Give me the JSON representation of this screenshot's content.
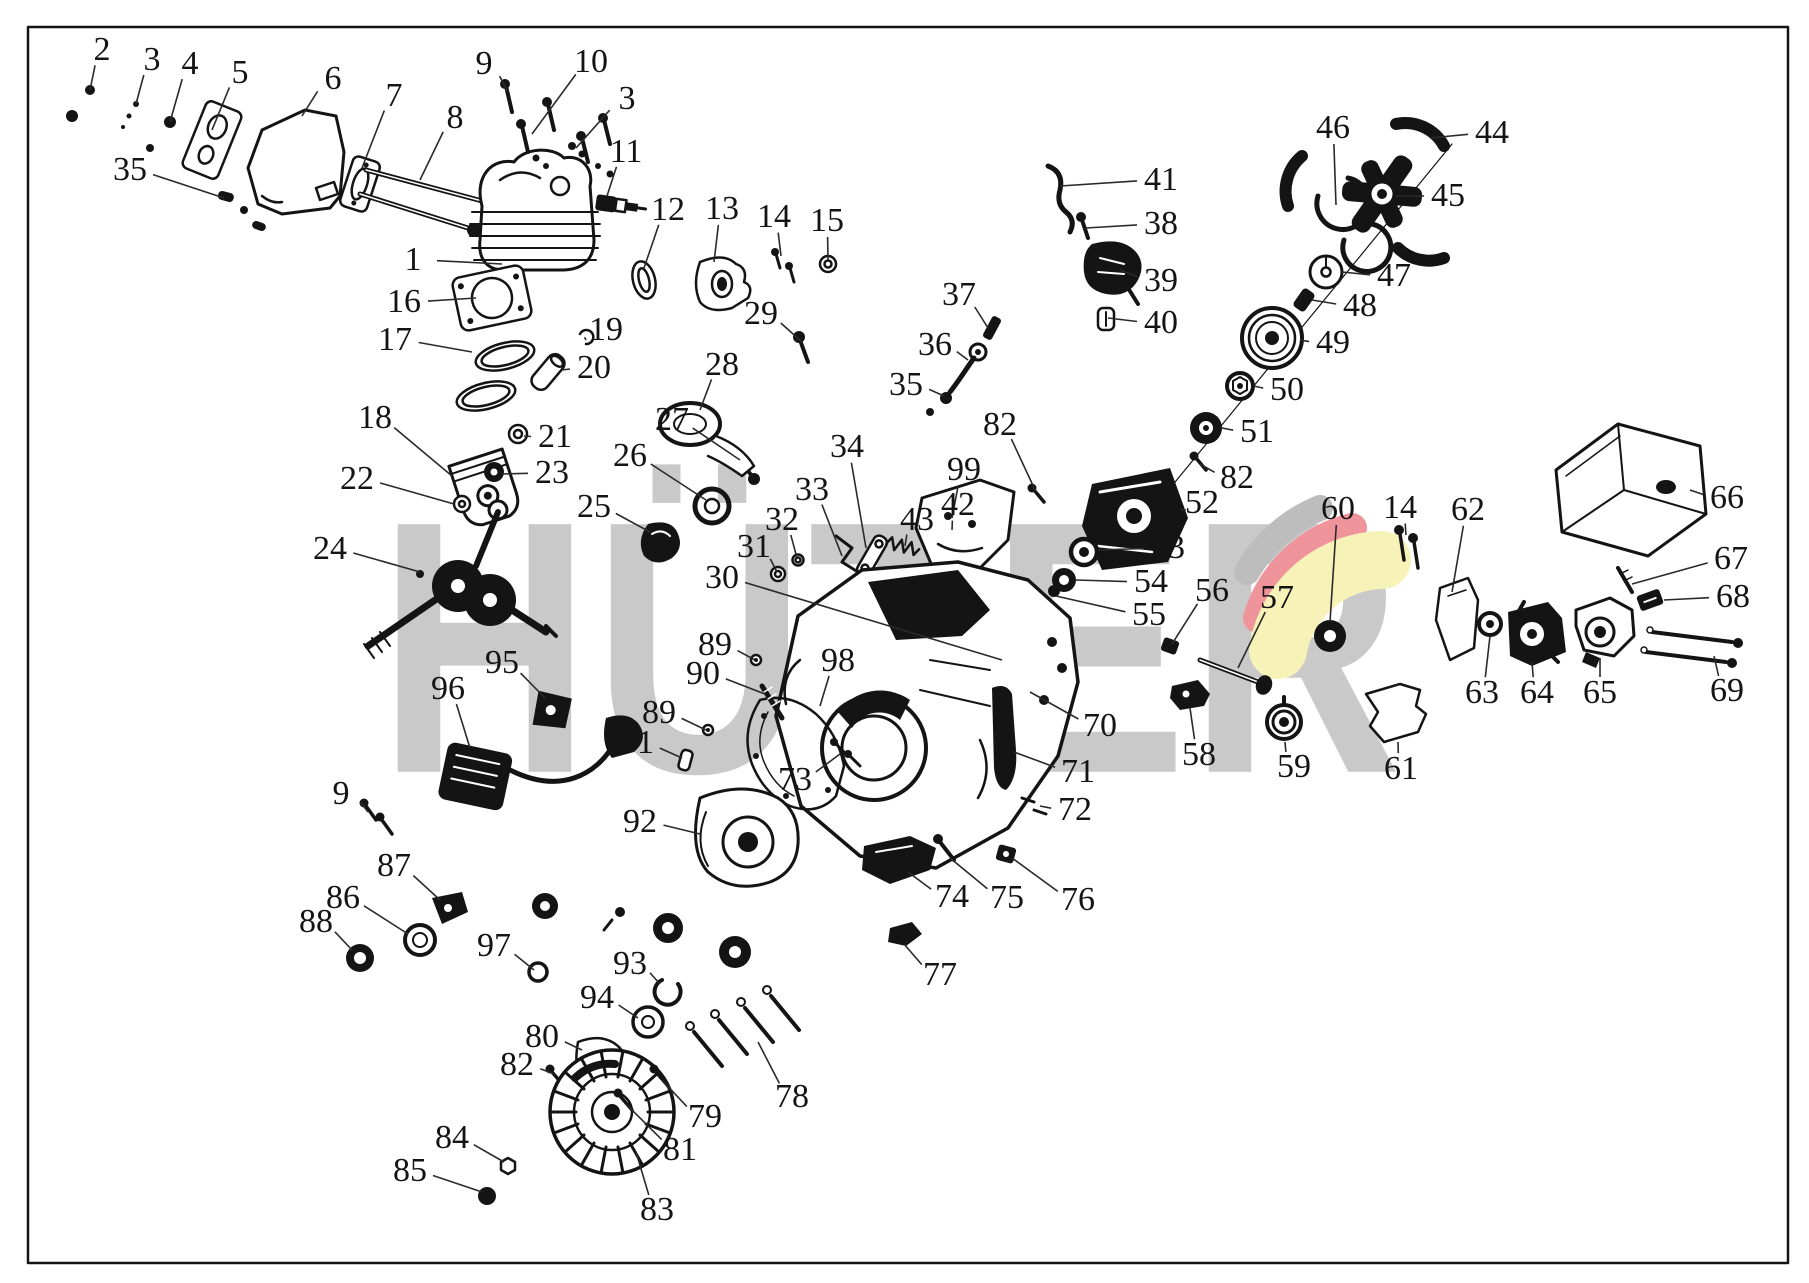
{
  "watermark": {
    "text": "HÜTER",
    "color": "#c9c9c9"
  },
  "logo": {
    "gray": "#bdbdbd",
    "red": "#f0949c",
    "yellow": "#f7f2b8"
  },
  "frame": {
    "border_color": "#141414"
  },
  "diagram": {
    "type": "exploded-parts-diagram",
    "callouts": [
      {
        "label": "2",
        "x": 102,
        "y": 50,
        "tx": 90,
        "ty": 90
      },
      {
        "label": "3",
        "x": 152,
        "y": 60,
        "tx": 136,
        "ty": 104
      },
      {
        "label": "4",
        "x": 190,
        "y": 64,
        "tx": 170,
        "ty": 122
      },
      {
        "label": "5",
        "x": 240,
        "y": 73,
        "tx": 212,
        "ty": 130
      },
      {
        "label": "6",
        "x": 333,
        "y": 79,
        "tx": 302,
        "ty": 116
      },
      {
        "label": "7",
        "x": 394,
        "y": 96,
        "tx": 362,
        "ty": 168
      },
      {
        "label": "8",
        "x": 455,
        "y": 118,
        "tx": 420,
        "ty": 180
      },
      {
        "label": "9",
        "x": 484,
        "y": 64,
        "tx": 508,
        "ty": 92
      },
      {
        "label": "10",
        "x": 591,
        "y": 62,
        "tx": 532,
        "ty": 134
      },
      {
        "label": "3",
        "x": 627,
        "y": 99,
        "tx": 576,
        "ty": 148
      },
      {
        "label": "11",
        "x": 626,
        "y": 152,
        "tx": 607,
        "ty": 196
      },
      {
        "label": "35",
        "x": 130,
        "y": 170,
        "tx": 224,
        "ty": 198
      },
      {
        "label": "12",
        "x": 668,
        "y": 210,
        "tx": 644,
        "ty": 268
      },
      {
        "label": "13",
        "x": 722,
        "y": 209,
        "tx": 714,
        "ty": 262
      },
      {
        "label": "14",
        "x": 774,
        "y": 217,
        "tx": 781,
        "ty": 256
      },
      {
        "label": "15",
        "x": 827,
        "y": 221,
        "tx": 828,
        "ty": 260
      },
      {
        "label": "1",
        "x": 413,
        "y": 260,
        "tx": 502,
        "ty": 264
      },
      {
        "label": "16",
        "x": 404,
        "y": 302,
        "tx": 476,
        "ty": 298
      },
      {
        "label": "17",
        "x": 395,
        "y": 340,
        "tx": 472,
        "ty": 352
      },
      {
        "label": "19",
        "x": 606,
        "y": 330,
        "tx": 586,
        "ty": 340
      },
      {
        "label": "20",
        "x": 594,
        "y": 368,
        "tx": 562,
        "ty": 370
      },
      {
        "label": "18",
        "x": 375,
        "y": 418,
        "tx": 452,
        "ty": 476
      },
      {
        "label": "21",
        "x": 555,
        "y": 437,
        "tx": 524,
        "ty": 436
      },
      {
        "label": "23",
        "x": 552,
        "y": 473,
        "tx": 502,
        "ty": 474
      },
      {
        "label": "22",
        "x": 357,
        "y": 479,
        "tx": 454,
        "ty": 504
      },
      {
        "label": "25",
        "x": 594,
        "y": 507,
        "tx": 650,
        "ty": 532
      },
      {
        "label": "26",
        "x": 630,
        "y": 456,
        "tx": 706,
        "ty": 500
      },
      {
        "label": "27",
        "x": 672,
        "y": 420,
        "tx": 740,
        "ty": 460
      },
      {
        "label": "28",
        "x": 722,
        "y": 365,
        "tx": 700,
        "ty": 410
      },
      {
        "label": "29",
        "x": 761,
        "y": 314,
        "tx": 802,
        "ty": 342
      },
      {
        "label": "24",
        "x": 330,
        "y": 549,
        "tx": 420,
        "ty": 572
      },
      {
        "label": "34",
        "x": 847,
        "y": 447,
        "tx": 866,
        "ty": 548
      },
      {
        "label": "33",
        "x": 812,
        "y": 490,
        "tx": 842,
        "ty": 556
      },
      {
        "label": "32",
        "x": 782,
        "y": 520,
        "tx": 797,
        "ty": 558
      },
      {
        "label": "31",
        "x": 754,
        "y": 547,
        "tx": 777,
        "ty": 572
      },
      {
        "label": "30",
        "x": 722,
        "y": 578,
        "tx": 1002,
        "ty": 660
      },
      {
        "label": "43",
        "x": 917,
        "y": 520,
        "tx": 905,
        "ty": 546
      },
      {
        "label": "42",
        "x": 958,
        "y": 505,
        "tx": 952,
        "ty": 530
      },
      {
        "label": "37",
        "x": 959,
        "y": 295,
        "tx": 988,
        "ty": 328
      },
      {
        "label": "36",
        "x": 935,
        "y": 345,
        "tx": 968,
        "ty": 360
      },
      {
        "label": "35",
        "x": 906,
        "y": 385,
        "tx": 944,
        "ty": 396
      },
      {
        "label": "41",
        "x": 1161,
        "y": 180,
        "tx": 1060,
        "ty": 186
      },
      {
        "label": "38",
        "x": 1161,
        "y": 224,
        "tx": 1086,
        "ty": 228
      },
      {
        "label": "39",
        "x": 1161,
        "y": 281,
        "tx": 1120,
        "ty": 270
      },
      {
        "label": "40",
        "x": 1161,
        "y": 323,
        "tx": 1108,
        "ty": 318
      },
      {
        "label": "46",
        "x": 1333,
        "y": 128,
        "tx": 1336,
        "ty": 205
      },
      {
        "label": "44",
        "x": 1492,
        "y": 133,
        "tx": 1430,
        "ty": 138
      },
      {
        "label": "45",
        "x": 1448,
        "y": 196,
        "tx": 1396,
        "ty": 196
      },
      {
        "label": "47",
        "x": 1394,
        "y": 276,
        "tx": 1342,
        "ty": 272
      },
      {
        "label": "48",
        "x": 1360,
        "y": 306,
        "tx": 1312,
        "ty": 300
      },
      {
        "label": "49",
        "x": 1333,
        "y": 343,
        "tx": 1300,
        "ty": 340
      },
      {
        "label": "50",
        "x": 1287,
        "y": 390,
        "tx": 1254,
        "ty": 386
      },
      {
        "label": "51",
        "x": 1257,
        "y": 432,
        "tx": 1222,
        "ty": 428
      },
      {
        "label": "82",
        "x": 1000,
        "y": 425,
        "tx": 1036,
        "ty": 492
      },
      {
        "label": "99",
        "x": 964,
        "y": 470,
        "tx": 952,
        "ty": 518
      },
      {
        "label": "82",
        "x": 1237,
        "y": 478,
        "tx": 1200,
        "ty": 464
      },
      {
        "label": "52",
        "x": 1202,
        "y": 503,
        "tx": 1186,
        "ty": 510
      },
      {
        "label": "53",
        "x": 1168,
        "y": 548,
        "tx": 1098,
        "ty": 550
      },
      {
        "label": "54",
        "x": 1151,
        "y": 582,
        "tx": 1076,
        "ty": 580
      },
      {
        "label": "55",
        "x": 1149,
        "y": 615,
        "tx": 1056,
        "ty": 596
      },
      {
        "label": "56",
        "x": 1212,
        "y": 591,
        "tx": 1172,
        "ty": 644
      },
      {
        "label": "57",
        "x": 1277,
        "y": 598,
        "tx": 1238,
        "ty": 668
      },
      {
        "label": "60",
        "x": 1338,
        "y": 509,
        "tx": 1330,
        "ty": 622
      },
      {
        "label": "14",
        "x": 1400,
        "y": 508,
        "tx": 1406,
        "ty": 535
      },
      {
        "label": "62",
        "x": 1468,
        "y": 510,
        "tx": 1452,
        "ty": 592
      },
      {
        "label": "63",
        "x": 1482,
        "y": 693,
        "tx": 1490,
        "ty": 636
      },
      {
        "label": "64",
        "x": 1537,
        "y": 693,
        "tx": 1532,
        "ty": 662
      },
      {
        "label": "65",
        "x": 1600,
        "y": 693,
        "tx": 1600,
        "ty": 658
      },
      {
        "label": "66",
        "x": 1727,
        "y": 498,
        "tx": 1690,
        "ty": 490
      },
      {
        "label": "67",
        "x": 1731,
        "y": 559,
        "tx": 1632,
        "ty": 584
      },
      {
        "label": "68",
        "x": 1733,
        "y": 597,
        "tx": 1664,
        "ty": 600
      },
      {
        "label": "69",
        "x": 1727,
        "y": 691,
        "tx": 1714,
        "ty": 656
      },
      {
        "label": "70",
        "x": 1100,
        "y": 726,
        "tx": 1030,
        "ty": 692
      },
      {
        "label": "71",
        "x": 1078,
        "y": 772,
        "tx": 1014,
        "ty": 752
      },
      {
        "label": "72",
        "x": 1075,
        "y": 810,
        "tx": 1040,
        "ty": 806
      },
      {
        "label": "58",
        "x": 1199,
        "y": 755,
        "tx": 1190,
        "ty": 708
      },
      {
        "label": "59",
        "x": 1294,
        "y": 767,
        "tx": 1285,
        "ty": 742
      },
      {
        "label": "61",
        "x": 1401,
        "y": 769,
        "tx": 1398,
        "ty": 742
      },
      {
        "label": "89",
        "x": 715,
        "y": 645,
        "tx": 755,
        "ty": 660
      },
      {
        "label": "90",
        "x": 703,
        "y": 674,
        "tx": 765,
        "ty": 694
      },
      {
        "label": "89",
        "x": 659,
        "y": 713,
        "tx": 706,
        "ty": 730
      },
      {
        "label": "91",
        "x": 637,
        "y": 743,
        "tx": 682,
        "ty": 758
      },
      {
        "label": "98",
        "x": 838,
        "y": 661,
        "tx": 820,
        "ty": 706
      },
      {
        "label": "73",
        "x": 795,
        "y": 780,
        "tx": 840,
        "ty": 754
      },
      {
        "label": "92",
        "x": 640,
        "y": 822,
        "tx": 700,
        "ty": 834
      },
      {
        "label": "95",
        "x": 502,
        "y": 663,
        "tx": 545,
        "ty": 698
      },
      {
        "label": "96",
        "x": 448,
        "y": 689,
        "tx": 470,
        "ty": 748
      },
      {
        "label": "9",
        "x": 341,
        "y": 794,
        "tx": 368,
        "ty": 812
      },
      {
        "label": "87",
        "x": 394,
        "y": 866,
        "tx": 440,
        "ty": 900
      },
      {
        "label": "86",
        "x": 343,
        "y": 898,
        "tx": 408,
        "ty": 934
      },
      {
        "label": "88",
        "x": 316,
        "y": 922,
        "tx": 352,
        "ty": 950
      },
      {
        "label": "97",
        "x": 494,
        "y": 946,
        "tx": 534,
        "ty": 970
      },
      {
        "label": "93",
        "x": 630,
        "y": 964,
        "tx": 660,
        "ty": 984
      },
      {
        "label": "94",
        "x": 597,
        "y": 998,
        "tx": 638,
        "ty": 1018
      },
      {
        "label": "80",
        "x": 542,
        "y": 1037,
        "tx": 582,
        "ty": 1050
      },
      {
        "label": "82",
        "x": 517,
        "y": 1065,
        "tx": 554,
        "ty": 1074
      },
      {
        "label": "84",
        "x": 452,
        "y": 1138,
        "tx": 504,
        "ty": 1162
      },
      {
        "label": "85",
        "x": 410,
        "y": 1171,
        "tx": 482,
        "ty": 1192
      },
      {
        "label": "83",
        "x": 657,
        "y": 1210,
        "tx": 636,
        "ty": 1152
      },
      {
        "label": "79",
        "x": 705,
        "y": 1117,
        "tx": 662,
        "ty": 1080
      },
      {
        "label": "81",
        "x": 680,
        "y": 1150,
        "tx": 626,
        "ty": 1104
      },
      {
        "label": "78",
        "x": 792,
        "y": 1097,
        "tx": 758,
        "ty": 1042
      },
      {
        "label": "74",
        "x": 952,
        "y": 897,
        "tx": 908,
        "ty": 872
      },
      {
        "label": "75",
        "x": 1007,
        "y": 898,
        "tx": 950,
        "ty": 858
      },
      {
        "label": "76",
        "x": 1078,
        "y": 900,
        "tx": 1012,
        "ty": 858
      },
      {
        "label": "77",
        "x": 940,
        "y": 975,
        "tx": 904,
        "ty": 944
      }
    ]
  }
}
